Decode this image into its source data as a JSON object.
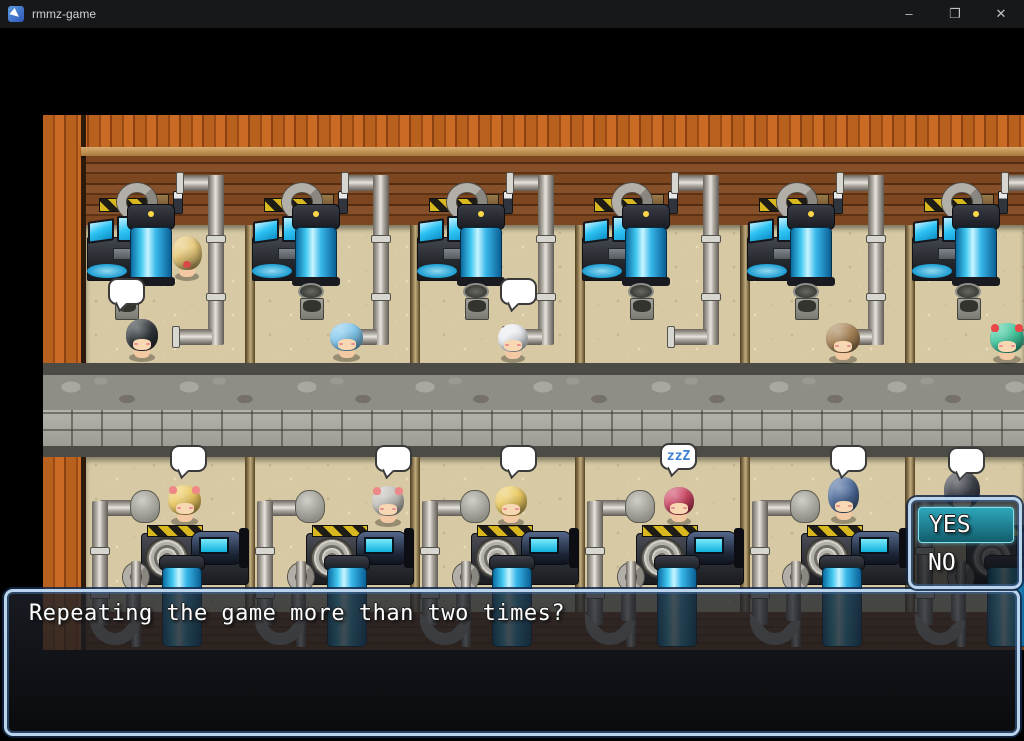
{
  "titlebar": {
    "title": "rmmz-game",
    "minimize_glyph": "–",
    "maximize_glyph": "❐",
    "close_glyph": "✕"
  },
  "message_window": {
    "text": "Repeating the game more than two times?"
  },
  "choice_window": {
    "options": [
      {
        "label": "YES",
        "selected": true
      },
      {
        "label": "NO",
        "selected": false
      }
    ]
  },
  "scene": {
    "room_count": 6,
    "sleep_bubble_text": "zzZ",
    "characters": [
      {
        "id": "player-blonde",
        "hair": "#e6c876",
        "x": 129,
        "y": 118,
        "w": 30,
        "h": 46,
        "facing": "up",
        "bow": "#d84848"
      },
      {
        "id": "npc-black-hair",
        "hair": "#30363a",
        "x": 83,
        "y": 201,
        "w": 32,
        "h": 44,
        "bubble": [
          65,
          163
        ]
      },
      {
        "id": "npc-lightblue-hair",
        "hair": "#82c8ee",
        "x": 287,
        "y": 205,
        "w": 33,
        "h": 40
      },
      {
        "id": "npc-white-hair",
        "hair": "#eaedf0",
        "x": 455,
        "y": 206,
        "w": 30,
        "h": 40,
        "bubble": [
          457,
          163
        ]
      },
      {
        "id": "npc-brown-hair",
        "hair": "#a88456",
        "x": 783,
        "y": 205,
        "w": 34,
        "h": 42
      },
      {
        "id": "npc-green-hair",
        "hair": "#40c89e",
        "x": 947,
        "y": 205,
        "w": 34,
        "h": 42,
        "ribbons": "#e84848"
      },
      {
        "id": "npc-blonde-bow",
        "hair": "#ecca62",
        "x": 125,
        "y": 367,
        "w": 33,
        "h": 42,
        "bubble": [
          127,
          330
        ],
        "ribbons": "#ee8888"
      },
      {
        "id": "npc-gray-hair",
        "hair": "#c6c2bc",
        "x": 329,
        "y": 368,
        "w": 32,
        "h": 42,
        "bubble": [
          332,
          330
        ],
        "ribbons": "#ee8888"
      },
      {
        "id": "npc-blonde-2",
        "hair": "#ecca62",
        "x": 452,
        "y": 368,
        "w": 32,
        "h": 42,
        "bubble": [
          457,
          330
        ]
      },
      {
        "id": "npc-red-hair",
        "hair": "#cc4462",
        "x": 621,
        "y": 369,
        "w": 30,
        "h": 40,
        "bubble": [
          617,
          328
        ],
        "bubble_label": "zzZ"
      },
      {
        "id": "npc-darkblue-hair",
        "hair": "#4e6c9c",
        "x": 785,
        "y": 359,
        "w": 31,
        "h": 48,
        "bubble": [
          787,
          330
        ]
      },
      {
        "id": "npc-dark-hair",
        "hair": "#3c4048",
        "x": 901,
        "y": 353,
        "w": 36,
        "h": 50,
        "bubble": [
          905,
          332
        ]
      }
    ],
    "bins": [
      [
        70,
        168
      ],
      [
        255,
        168
      ],
      [
        420,
        168
      ],
      [
        585,
        168
      ],
      [
        750,
        168
      ],
      [
        912,
        168
      ]
    ],
    "sacks": [
      [
        87,
        375
      ],
      [
        252,
        375
      ],
      [
        417,
        375
      ],
      [
        582,
        375
      ],
      [
        747,
        375
      ]
    ],
    "top_pipes": [
      179,
      344,
      509,
      674,
      839,
      1004
    ],
    "bottom_pipes": [
      57,
      222,
      387,
      552,
      717,
      882
    ]
  },
  "colors": {
    "wood_outer": "#b25a1c",
    "wood_wall": "#6e3d1c",
    "floor": "#d6c9a4",
    "path": "#8e8d86",
    "tank_blue": "#38c0ee",
    "hazard_yellow": "#d8b81e",
    "bubble_fill": "#ffffff",
    "selection_teal": "#1f87a0",
    "window_border": "#b9d4ec",
    "titlebar_bg": "#17181a"
  }
}
